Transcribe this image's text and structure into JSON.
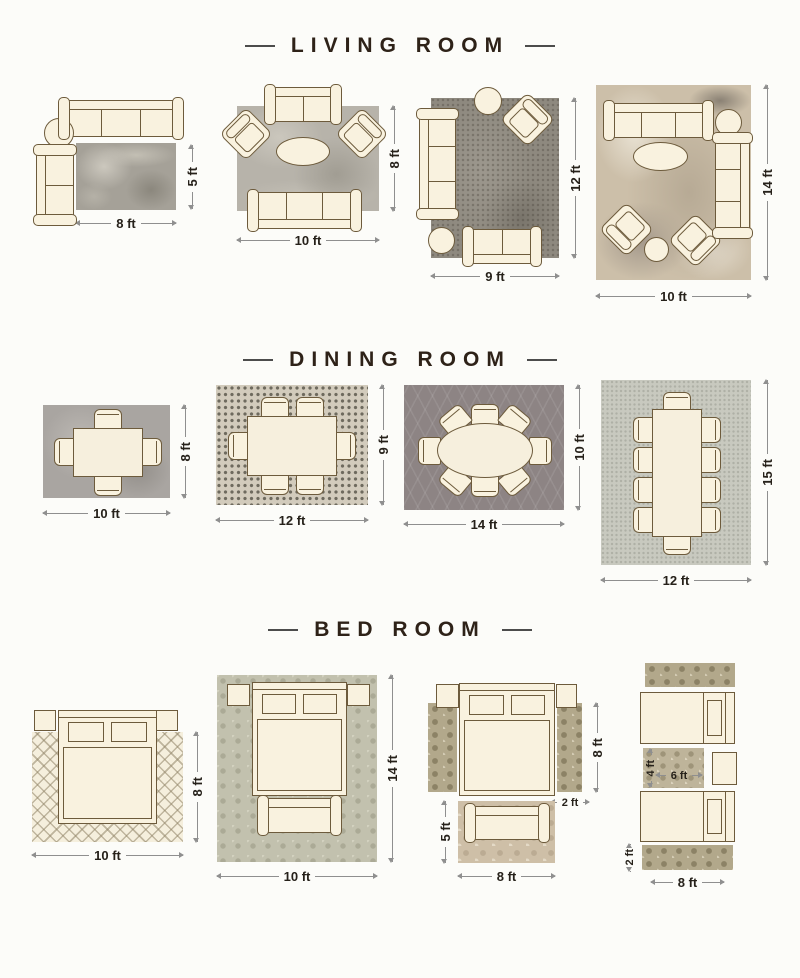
{
  "colors": {
    "furniture_outline": "#6d5b3c",
    "furniture_fill": "#f9f2df",
    "dimension_line": "#8f8f8f",
    "dimension_text": "#26211a",
    "title_text": "#2e2218",
    "background": "#fcfcf9"
  },
  "sections": [
    {
      "id": "living-room",
      "title": "LIVING ROOM",
      "layouts": [
        {
          "name": "8 x 5 rug with two sofas and side table",
          "width_label": "8 ft",
          "height_label": "5 ft"
        },
        {
          "name": "10 x 8 rug with sofas, two armchairs and oval table",
          "width_label": "10 ft",
          "height_label": "8 ft"
        },
        {
          "name": "9 x 12 rug with sofas, armchair and round tables",
          "width_label": "9 ft",
          "height_label": "12 ft"
        },
        {
          "name": "10 x 14 rug with full seating group",
          "width_label": "10 ft",
          "height_label": "14 ft"
        }
      ]
    },
    {
      "id": "dining-room",
      "title": "DINING ROOM",
      "layouts": [
        {
          "name": "10 x 8 rug, table with 4 chairs",
          "width_label": "10 ft",
          "height_label": "8 ft"
        },
        {
          "name": "12 x 9 rug, table with 6 chairs",
          "width_label": "12 ft",
          "height_label": "9 ft"
        },
        {
          "name": "14 x 10 rug, oval table with 8 chairs",
          "width_label": "14 ft",
          "height_label": "10 ft"
        },
        {
          "name": "12 x 15 rug, long table with 10 chairs",
          "width_label": "12 ft",
          "height_label": "15 ft"
        }
      ]
    },
    {
      "id": "bed-room",
      "title": "BED ROOM",
      "layouts": [
        {
          "name": "10 x 8 rug under queen bed",
          "width_label": "10 ft",
          "height_label": "8 ft"
        },
        {
          "name": "10 x 14 rug under bed and bench",
          "width_label": "10 ft",
          "height_label": "14 ft"
        },
        {
          "name": "bedside runners and foot-of-bed rug",
          "runner_length_label": "8 ft",
          "runner_width_label": "2 ft",
          "foot_rug_height_label": "5 ft",
          "foot_rug_width_label": "8 ft"
        },
        {
          "name": "twin beds with runners and accent rug",
          "accent_rug_height_label": "4 ft",
          "accent_rug_width_label": "6 ft",
          "runner_width_label": "2 ft",
          "width_label": "8 ft"
        }
      ]
    }
  ]
}
